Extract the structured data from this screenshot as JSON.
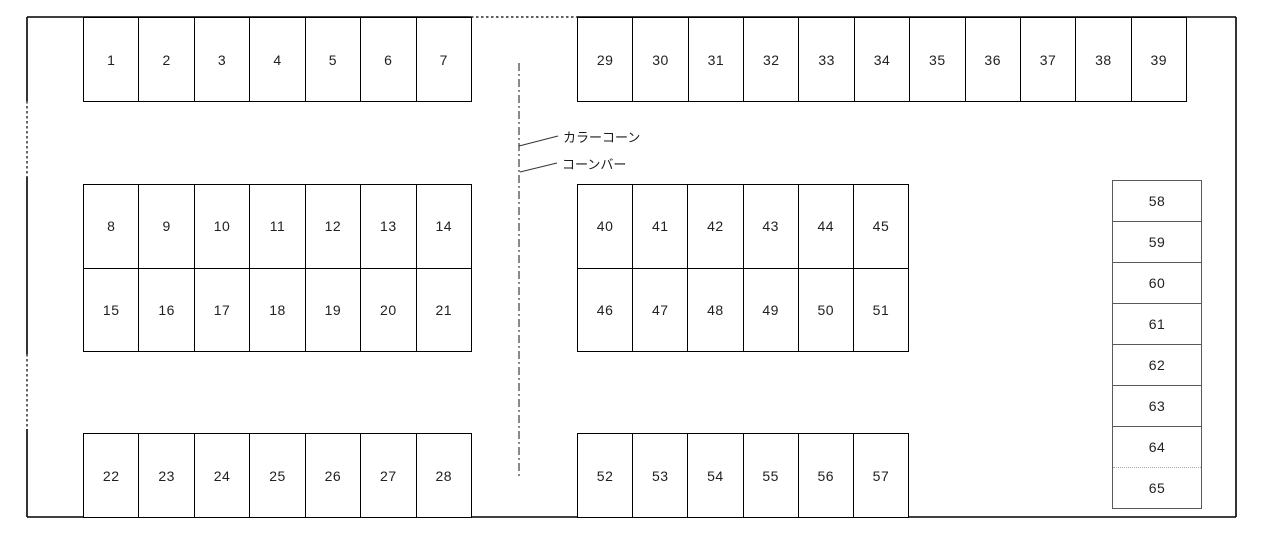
{
  "diagram": {
    "title": "parking-lot-layout",
    "annotations": {
      "color_cone_label": "カラーコーン",
      "cone_bar_label": "コーンバー"
    },
    "blocks": {
      "top_left": {
        "cells": [
          "1",
          "2",
          "3",
          "4",
          "5",
          "6",
          "7"
        ]
      },
      "top_right": {
        "cells": [
          "29",
          "30",
          "31",
          "32",
          "33",
          "34",
          "35",
          "36",
          "37",
          "38",
          "39"
        ]
      },
      "mid_left": {
        "rows": [
          [
            "8",
            "9",
            "10",
            "11",
            "12",
            "13",
            "14"
          ],
          [
            "15",
            "16",
            "17",
            "18",
            "19",
            "20",
            "21"
          ]
        ]
      },
      "mid_right": {
        "rows": [
          [
            "40",
            "41",
            "42",
            "43",
            "44",
            "45"
          ],
          [
            "46",
            "47",
            "48",
            "49",
            "50",
            "51"
          ]
        ]
      },
      "bottom_left": {
        "cells": [
          "22",
          "23",
          "24",
          "25",
          "26",
          "27",
          "28"
        ]
      },
      "bottom_right": {
        "cells": [
          "52",
          "53",
          "54",
          "55",
          "56",
          "57"
        ]
      },
      "right_column": {
        "cells": [
          "58",
          "59",
          "60",
          "61",
          "62",
          "63",
          "64",
          "65"
        ]
      }
    },
    "colors": {
      "outline": "#000000",
      "column_outline": "#595959",
      "center_line": "#3a3a3a",
      "background": "#ffffff"
    }
  }
}
